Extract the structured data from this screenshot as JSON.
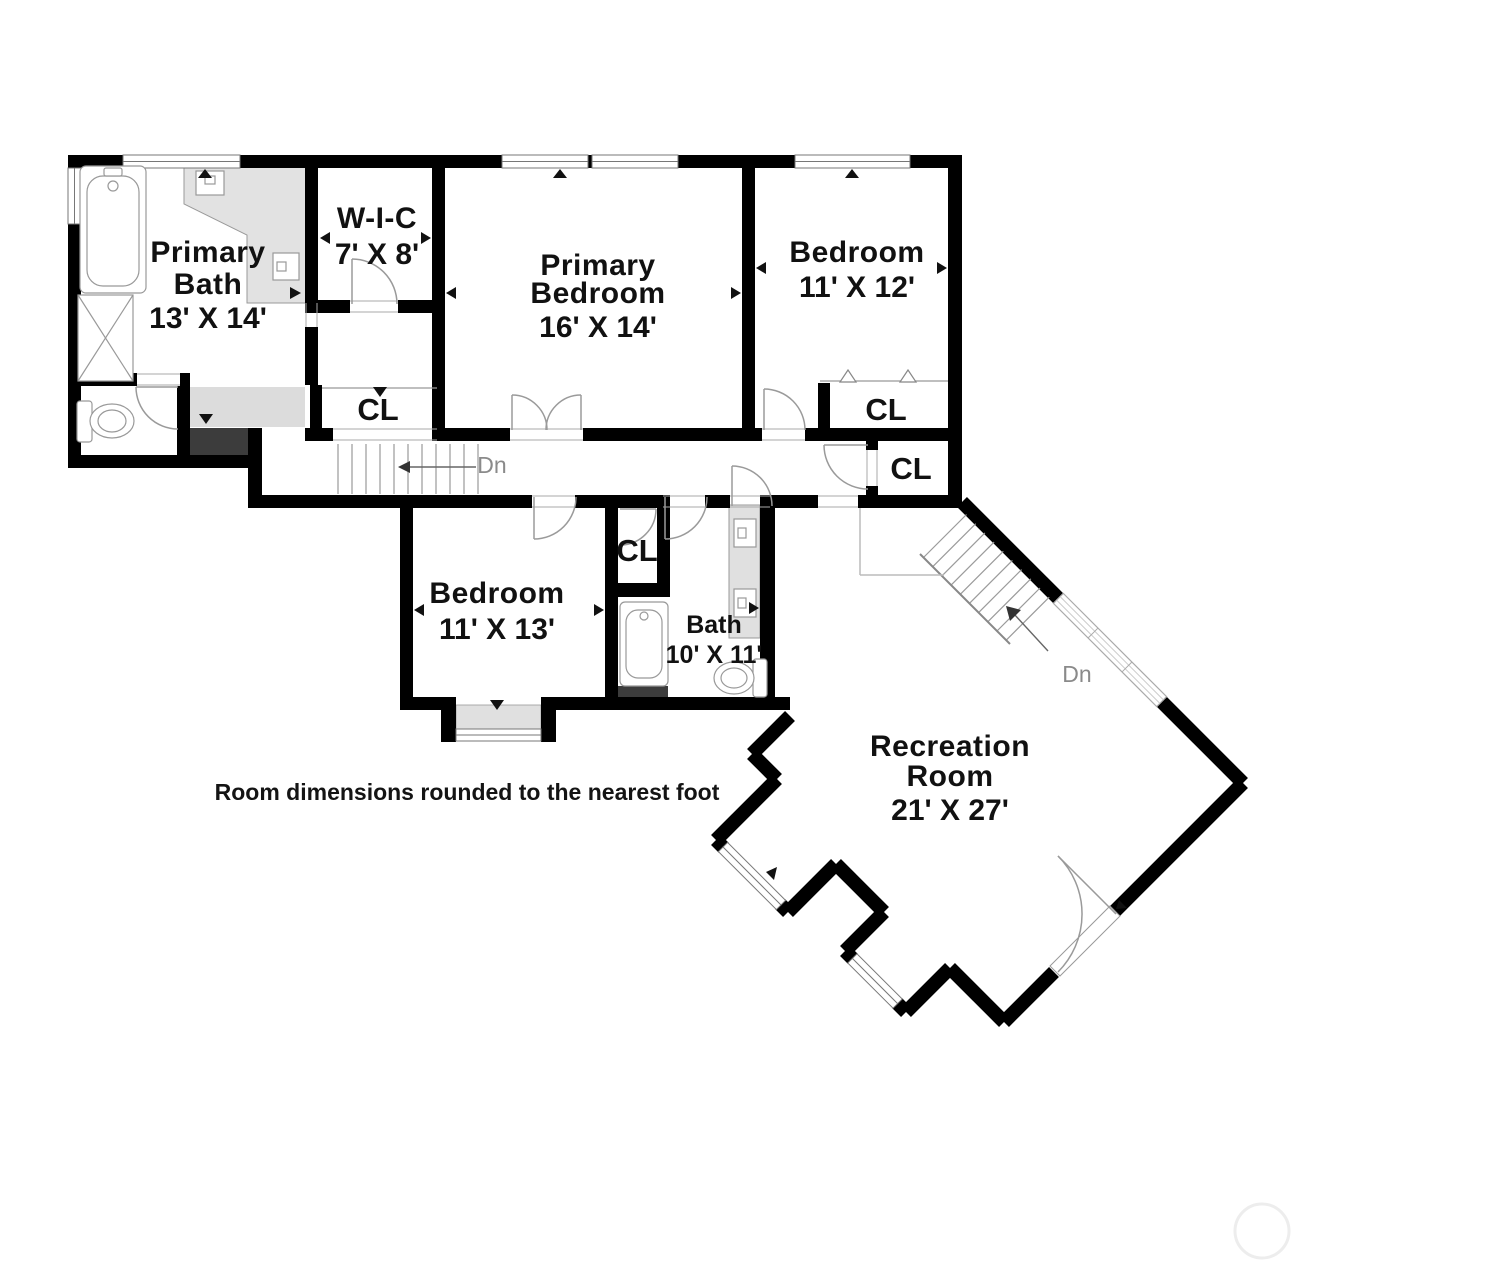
{
  "plan": {
    "type": "floor-plan",
    "footnote": "Room dimensions rounded to the nearest foot"
  },
  "rooms": [
    {
      "id": "primary-bath",
      "name_lines": [
        "Primary",
        "Bath"
      ],
      "dimensions": "13' X 14'"
    },
    {
      "id": "walk-in-closet",
      "name_lines": [
        "W-I-C"
      ],
      "dimensions": "7' X 8'"
    },
    {
      "id": "primary-bedroom",
      "name_lines": [
        "Primary",
        "Bedroom"
      ],
      "dimensions": "16' X 14'"
    },
    {
      "id": "bedroom-upper",
      "name_lines": [
        "Bedroom"
      ],
      "dimensions": "11' X 12'"
    },
    {
      "id": "bedroom-lower",
      "name_lines": [
        "Bedroom"
      ],
      "dimensions": "11' X 13'"
    },
    {
      "id": "bath",
      "name_lines": [
        "Bath"
      ],
      "dimensions": "10' X 11'"
    },
    {
      "id": "recreation-room",
      "name_lines": [
        "Recreation",
        "Room"
      ],
      "dimensions": "21' X 27'"
    }
  ],
  "labels": {
    "closet": "CL",
    "down": "Dn"
  },
  "colors": {
    "wall": "#000000",
    "fixture_line": "#999999",
    "light_fill": "#e0e0e0",
    "strip_fill": "#dcdcdc",
    "dark_fill": "#3c3c3c",
    "label_text": "#111111",
    "muted_text": "#8a8a8a"
  }
}
